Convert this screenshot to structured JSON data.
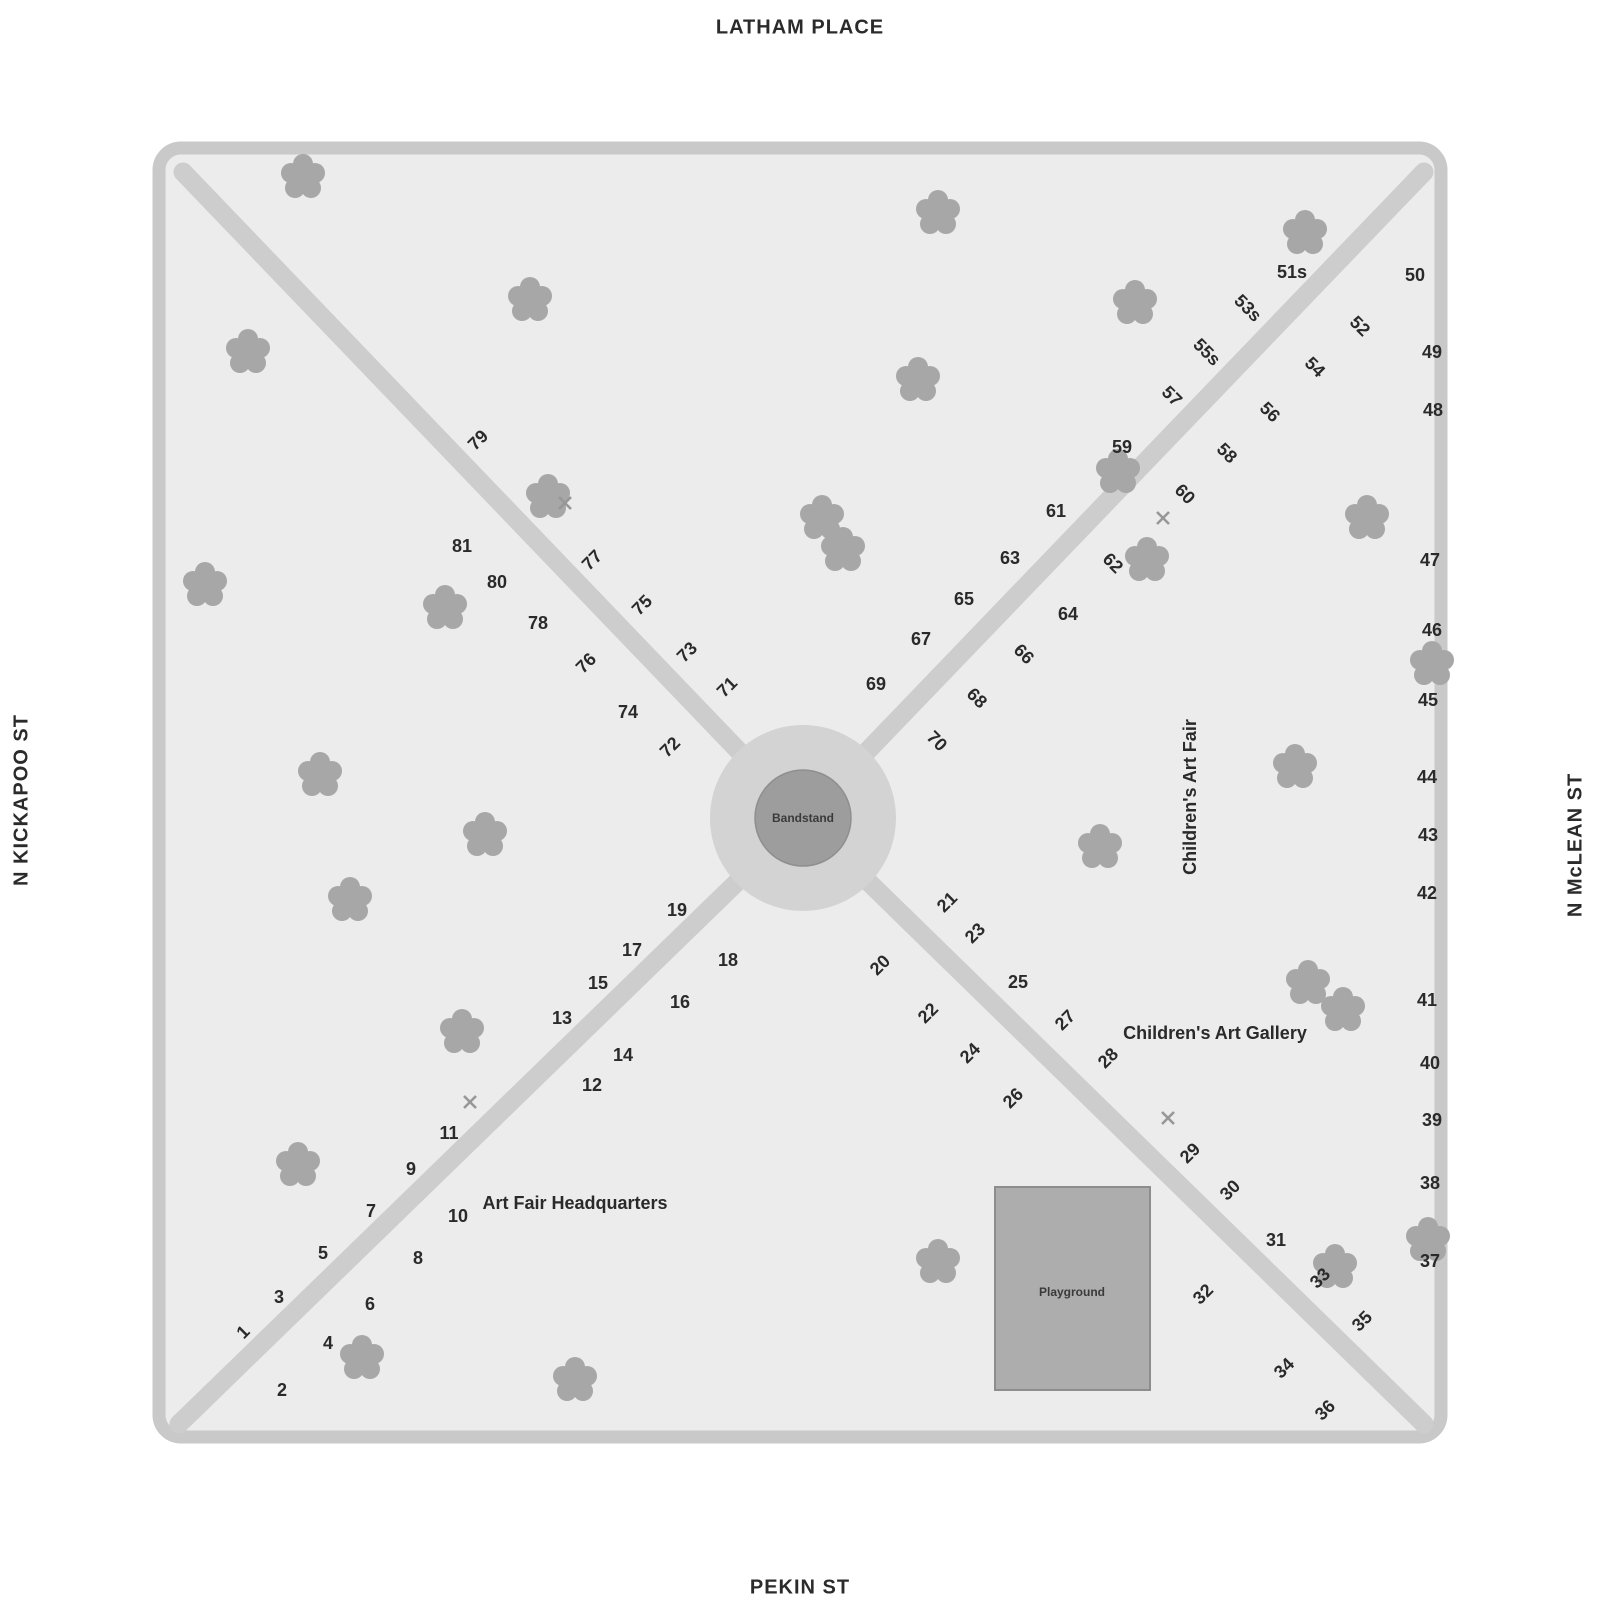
{
  "streets": {
    "top": "LATHAM PLACE",
    "bottom": "PEKIN ST",
    "left": "N KICKAPOO ST",
    "right": "N McLEAN ST"
  },
  "park": {
    "bandstand_label": "Bandstand",
    "playground_label": "Playground"
  },
  "areas": [
    {
      "label": "Children's Art Fair",
      "x": 1190,
      "y": 797,
      "r": -90
    },
    {
      "label": "Children's Art Gallery",
      "x": 1215,
      "y": 1033,
      "r": 0
    },
    {
      "label": "Art Fair Headquarters",
      "x": 575,
      "y": 1203,
      "r": 0
    }
  ],
  "booths": [
    {
      "n": "1",
      "x": 243,
      "y": 1332,
      "r": -45
    },
    {
      "n": "2",
      "x": 282,
      "y": 1390,
      "r": 0
    },
    {
      "n": "3",
      "x": 279,
      "y": 1297,
      "r": 0
    },
    {
      "n": "4",
      "x": 328,
      "y": 1343,
      "r": 0
    },
    {
      "n": "5",
      "x": 323,
      "y": 1253,
      "r": 0
    },
    {
      "n": "6",
      "x": 370,
      "y": 1304,
      "r": 0
    },
    {
      "n": "7",
      "x": 371,
      "y": 1211,
      "r": 0
    },
    {
      "n": "8",
      "x": 418,
      "y": 1258,
      "r": 0
    },
    {
      "n": "9",
      "x": 411,
      "y": 1169,
      "r": 0
    },
    {
      "n": "10",
      "x": 458,
      "y": 1216,
      "r": 0
    },
    {
      "n": "11",
      "x": 449,
      "y": 1133,
      "r": 0
    },
    {
      "n": "12",
      "x": 592,
      "y": 1085,
      "r": 0
    },
    {
      "n": "13",
      "x": 562,
      "y": 1018,
      "r": 0
    },
    {
      "n": "14",
      "x": 623,
      "y": 1055,
      "r": 0
    },
    {
      "n": "15",
      "x": 598,
      "y": 983,
      "r": 0
    },
    {
      "n": "16",
      "x": 680,
      "y": 1002,
      "r": 0
    },
    {
      "n": "17",
      "x": 632,
      "y": 950,
      "r": 0
    },
    {
      "n": "18",
      "x": 728,
      "y": 960,
      "r": 0
    },
    {
      "n": "19",
      "x": 677,
      "y": 910,
      "r": 0
    },
    {
      "n": "20",
      "x": 880,
      "y": 965,
      "r": -45
    },
    {
      "n": "21",
      "x": 947,
      "y": 902,
      "r": -45
    },
    {
      "n": "22",
      "x": 928,
      "y": 1013,
      "r": -45
    },
    {
      "n": "23",
      "x": 975,
      "y": 933,
      "r": -45
    },
    {
      "n": "24",
      "x": 970,
      "y": 1053,
      "r": -45
    },
    {
      "n": "25",
      "x": 1018,
      "y": 982,
      "r": 0
    },
    {
      "n": "26",
      "x": 1013,
      "y": 1098,
      "r": -45
    },
    {
      "n": "27",
      "x": 1065,
      "y": 1020,
      "r": -45
    },
    {
      "n": "28",
      "x": 1108,
      "y": 1058,
      "r": -45
    },
    {
      "n": "29",
      "x": 1190,
      "y": 1153,
      "r": -45
    },
    {
      "n": "30",
      "x": 1230,
      "y": 1190,
      "r": -45
    },
    {
      "n": "31",
      "x": 1276,
      "y": 1240,
      "r": 0
    },
    {
      "n": "32",
      "x": 1203,
      "y": 1294,
      "r": -45
    },
    {
      "n": "33",
      "x": 1320,
      "y": 1278,
      "r": -45
    },
    {
      "n": "34",
      "x": 1284,
      "y": 1368,
      "r": -45
    },
    {
      "n": "35",
      "x": 1362,
      "y": 1321,
      "r": -45
    },
    {
      "n": "36",
      "x": 1325,
      "y": 1410,
      "r": -45
    },
    {
      "n": "37",
      "x": 1430,
      "y": 1261,
      "r": 0
    },
    {
      "n": "38",
      "x": 1430,
      "y": 1183,
      "r": 0
    },
    {
      "n": "39",
      "x": 1432,
      "y": 1120,
      "r": 0
    },
    {
      "n": "40",
      "x": 1430,
      "y": 1063,
      "r": 0
    },
    {
      "n": "41",
      "x": 1427,
      "y": 1000,
      "r": 0
    },
    {
      "n": "42",
      "x": 1427,
      "y": 893,
      "r": 0
    },
    {
      "n": "43",
      "x": 1428,
      "y": 835,
      "r": 0
    },
    {
      "n": "44",
      "x": 1427,
      "y": 777,
      "r": 0
    },
    {
      "n": "45",
      "x": 1428,
      "y": 700,
      "r": 0
    },
    {
      "n": "46",
      "x": 1432,
      "y": 630,
      "r": 0
    },
    {
      "n": "47",
      "x": 1430,
      "y": 560,
      "r": 0
    },
    {
      "n": "48",
      "x": 1433,
      "y": 410,
      "r": 0
    },
    {
      "n": "49",
      "x": 1432,
      "y": 352,
      "r": 0
    },
    {
      "n": "50",
      "x": 1415,
      "y": 275,
      "r": 0
    },
    {
      "n": "51s",
      "x": 1292,
      "y": 272,
      "r": 0
    },
    {
      "n": "52",
      "x": 1360,
      "y": 326,
      "r": 45
    },
    {
      "n": "53s",
      "x": 1248,
      "y": 308,
      "r": 45
    },
    {
      "n": "54",
      "x": 1315,
      "y": 367,
      "r": 45
    },
    {
      "n": "55s",
      "x": 1207,
      "y": 352,
      "r": 45
    },
    {
      "n": "56",
      "x": 1270,
      "y": 412,
      "r": 45
    },
    {
      "n": "57",
      "x": 1172,
      "y": 396,
      "r": 45
    },
    {
      "n": "58",
      "x": 1227,
      "y": 453,
      "r": 45
    },
    {
      "n": "59",
      "x": 1122,
      "y": 447,
      "r": 0
    },
    {
      "n": "60",
      "x": 1185,
      "y": 494,
      "r": 45
    },
    {
      "n": "61",
      "x": 1056,
      "y": 511,
      "r": 0
    },
    {
      "n": "62",
      "x": 1113,
      "y": 563,
      "r": 45
    },
    {
      "n": "63",
      "x": 1010,
      "y": 558,
      "r": 0
    },
    {
      "n": "64",
      "x": 1068,
      "y": 614,
      "r": 0
    },
    {
      "n": "65",
      "x": 964,
      "y": 599,
      "r": 0
    },
    {
      "n": "66",
      "x": 1024,
      "y": 654,
      "r": 45
    },
    {
      "n": "67",
      "x": 921,
      "y": 639,
      "r": 0
    },
    {
      "n": "68",
      "x": 977,
      "y": 698,
      "r": 45
    },
    {
      "n": "69",
      "x": 876,
      "y": 684,
      "r": 0
    },
    {
      "n": "70",
      "x": 937,
      "y": 741,
      "r": 45
    },
    {
      "n": "71",
      "x": 727,
      "y": 687,
      "r": -45
    },
    {
      "n": "72",
      "x": 670,
      "y": 747,
      "r": -45
    },
    {
      "n": "73",
      "x": 687,
      "y": 652,
      "r": -45
    },
    {
      "n": "74",
      "x": 628,
      "y": 712,
      "r": 0
    },
    {
      "n": "75",
      "x": 642,
      "y": 605,
      "r": -45
    },
    {
      "n": "76",
      "x": 586,
      "y": 663,
      "r": -45
    },
    {
      "n": "77",
      "x": 592,
      "y": 560,
      "r": -45
    },
    {
      "n": "78",
      "x": 538,
      "y": 623,
      "r": 0
    },
    {
      "n": "79",
      "x": 478,
      "y": 440,
      "r": -45
    },
    {
      "n": "80",
      "x": 497,
      "y": 582,
      "r": 0
    },
    {
      "n": "81",
      "x": 462,
      "y": 546,
      "r": 0
    }
  ],
  "trees": [
    {
      "x": 303,
      "y": 177
    },
    {
      "x": 938,
      "y": 213
    },
    {
      "x": 530,
      "y": 300
    },
    {
      "x": 248,
      "y": 352
    },
    {
      "x": 1135,
      "y": 303
    },
    {
      "x": 1305,
      "y": 233
    },
    {
      "x": 918,
      "y": 380
    },
    {
      "x": 1118,
      "y": 472
    },
    {
      "x": 548,
      "y": 497
    },
    {
      "x": 822,
      "y": 518
    },
    {
      "x": 843,
      "y": 550
    },
    {
      "x": 205,
      "y": 585
    },
    {
      "x": 445,
      "y": 608
    },
    {
      "x": 1147,
      "y": 560
    },
    {
      "x": 1367,
      "y": 518
    },
    {
      "x": 1432,
      "y": 664
    },
    {
      "x": 1295,
      "y": 767
    },
    {
      "x": 1100,
      "y": 847
    },
    {
      "x": 320,
      "y": 775
    },
    {
      "x": 485,
      "y": 835
    },
    {
      "x": 350,
      "y": 900
    },
    {
      "x": 462,
      "y": 1032
    },
    {
      "x": 1308,
      "y": 983
    },
    {
      "x": 1343,
      "y": 1010
    },
    {
      "x": 298,
      "y": 1165
    },
    {
      "x": 362,
      "y": 1358
    },
    {
      "x": 575,
      "y": 1380
    },
    {
      "x": 938,
      "y": 1262
    },
    {
      "x": 1335,
      "y": 1267
    },
    {
      "x": 1428,
      "y": 1240
    }
  ],
  "x_markers": [
    {
      "x": 565,
      "y": 503
    },
    {
      "x": 1163,
      "y": 518
    },
    {
      "x": 470,
      "y": 1102
    },
    {
      "x": 1168,
      "y": 1118
    }
  ],
  "colors": {
    "park_fill": "#ececec",
    "perimeter_path": "#c9c9c9",
    "diagonal_path": "#cdcdcd",
    "bandstand_outer": "#d3d3d3",
    "bandstand_inner": "#9d9d9d",
    "playground": "#adadad",
    "tree": "#a7a7a7",
    "text": "#2a2a2a"
  }
}
